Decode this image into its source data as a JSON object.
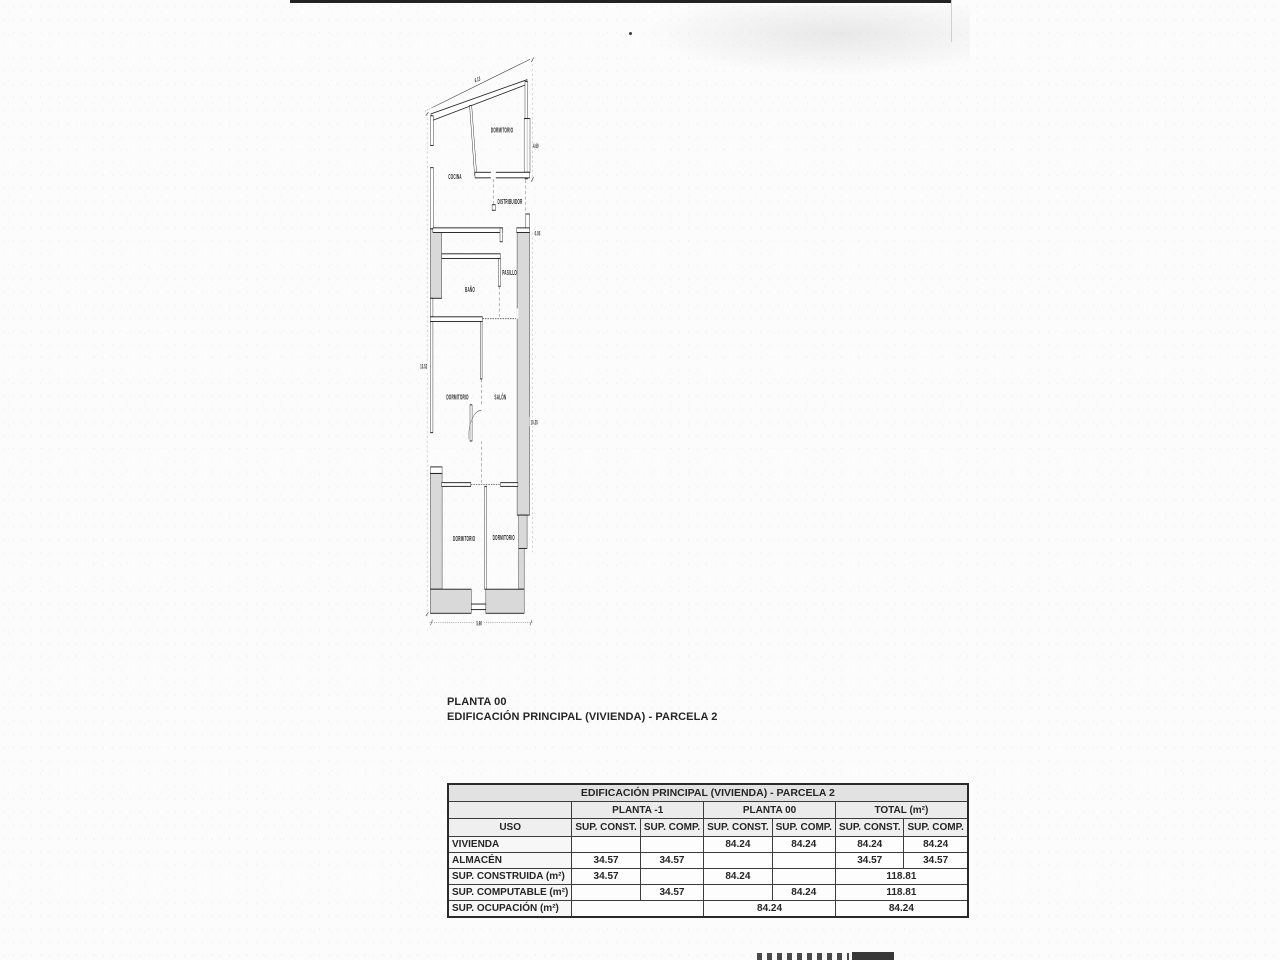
{
  "caption": {
    "line1": "PLANTA 00",
    "line2": "EDIFICACIÓN PRINCIPAL (VIVIENDA) - PARCELA 2"
  },
  "floor_plan": {
    "rooms": {
      "dormitorio_top": "DORMITORIO",
      "cocina": "COCINA",
      "distribuidor": "DISTRIBUIDOR",
      "pasillo": "PASILLO",
      "bano": "BAÑO",
      "dormitorio_mid": "DORMITORIO",
      "salon": "SALÓN",
      "dormitorio_bl": "DORMITORIO",
      "dormitorio_br": "DORMITORIO"
    },
    "dimensions": {
      "top": "6.13",
      "right_upper": "4.60",
      "right_step": "0.05",
      "left": "13.52",
      "right_lower": "10.25",
      "bottom": "5.90"
    }
  },
  "table": {
    "title": "EDIFICACIÓN PRINCIPAL (VIVIENDA) - PARCELA 2",
    "uso": "USO",
    "col_groups": {
      "planta_m1": "PLANTA -1",
      "planta_00": "PLANTA 00",
      "total": "TOTAL (m²)"
    },
    "sub": {
      "const": "SUP. CONST.",
      "comp": "SUP. COMP."
    },
    "rows": [
      {
        "label": "VIVIENDA",
        "cells": [
          "",
          "",
          "84.24",
          "84.24",
          "84.24",
          "84.24"
        ]
      },
      {
        "label": "ALMACÉN",
        "cells": [
          "34.57",
          "34.57",
          "",
          "",
          "34.57",
          "34.57"
        ]
      },
      {
        "label": "SUP. CONSTRUIDA (m²)",
        "cells": [
          "34.57",
          "",
          "84.24",
          "",
          "118.81"
        ]
      },
      {
        "label": "SUP. COMPUTABLE (m²)",
        "cells": [
          "",
          "34.57",
          "",
          "84.24",
          "118.81"
        ]
      },
      {
        "label": "SUP. OCUPACIÓN (m²)",
        "cells": [
          "",
          "84.24",
          "84.24"
        ]
      }
    ]
  }
}
